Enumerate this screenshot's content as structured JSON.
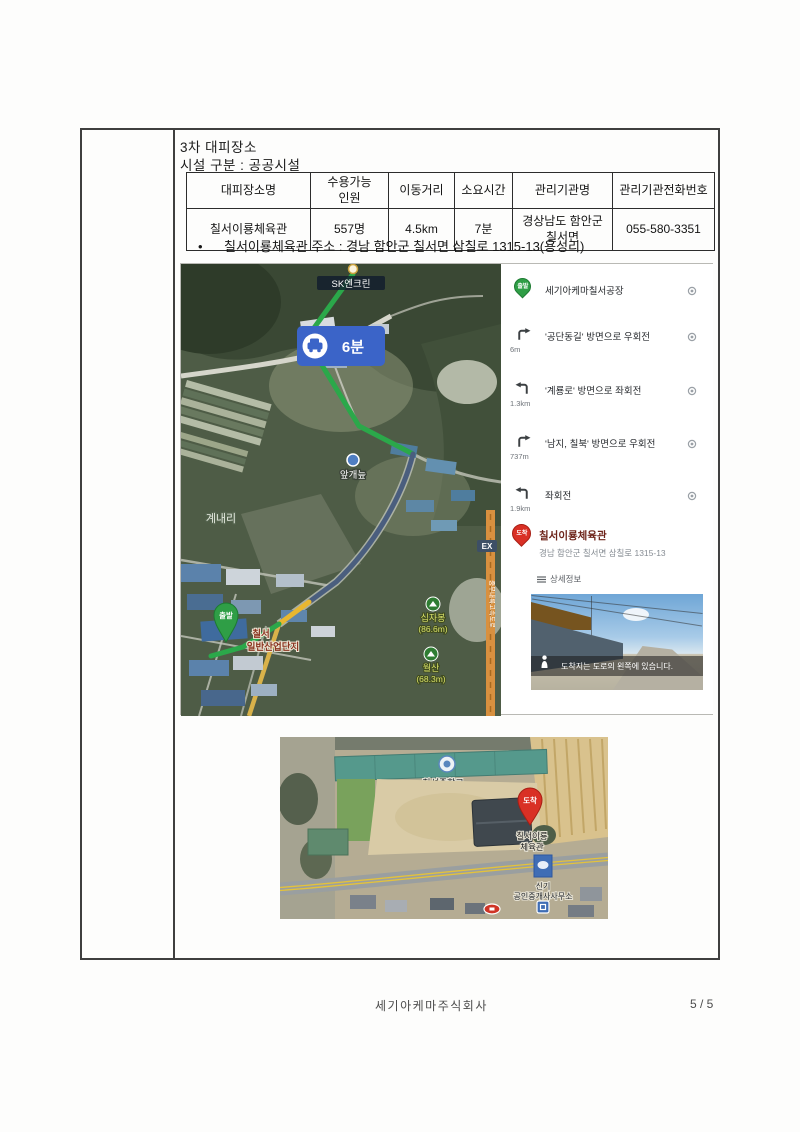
{
  "document": {
    "title": "3차 대피장소",
    "subtitle": "시설 구분 : 공공시설",
    "bullet": "칠서이룡체육관 주소 : 경남 함안군 칠서면 삼칠로 1315-13(용성리)",
    "footer_company": "세기아케마주식회사",
    "footer_page": "5 / 5"
  },
  "table": {
    "headers": {
      "name": "대피장소명",
      "capacity_l1": "수용가능",
      "capacity_l2": "인원",
      "distance": "이동거리",
      "time": "소요시간",
      "agency": "관리기관명",
      "phone": "관리기관전화번호"
    },
    "row": {
      "name": "칠서이룡체육관",
      "capacity": "557명",
      "distance": "4.5km",
      "time": "7분",
      "agency_l1": "경상남도 함안군",
      "agency_l2": "칠서면",
      "phone": "055-580-3351"
    }
  },
  "route_map": {
    "sk_station": "SK엔크린",
    "road_badge": "1021",
    "duration_badge": "6분",
    "wetland": "앞개늪",
    "village": "계내리",
    "ex_badge": "EX",
    "expressway": "중부내륙고속도로",
    "peak1_name": "십자봉",
    "peak1_elev": "(86.6m)",
    "peak2_name": "월산",
    "peak2_elev": "(68.3m)",
    "start_pin": "출발",
    "start_label_l1": "칠서",
    "start_label_l2": "일반산업단지",
    "colors": {
      "route_green": "#2ba84a",
      "route_blue": "#4a5e7e",
      "route_yellow": "#e8b730",
      "badge_blue": "#3b64c8"
    }
  },
  "directions": {
    "steps": [
      {
        "label": "세기아케마칠서공장",
        "distance": ""
      },
      {
        "label": "'공단동길' 방면으로 우회전",
        "distance": "6m"
      },
      {
        "label": "'계룡로' 방면으로 좌회전",
        "distance": "1.3km"
      },
      {
        "label": "'남지, 칠북' 방면으로 우회전",
        "distance": "737m"
      },
      {
        "label": "좌회전",
        "distance": "1.9km"
      }
    ],
    "dest_pin": "도착",
    "dest_name": "칠서이룡체육관",
    "dest_address": "경남 함안군 칠서면 삼칠로 1315-13",
    "details_label": "상세정보",
    "streetview_caption": "도착지는 도로의 왼쪽에 있습니다."
  },
  "site_map": {
    "school": "칠성중학교",
    "arrive_pin": "도착",
    "gym_l1": "칠서이룡",
    "gym_l2": "체육관",
    "office_l1": "신기",
    "office_l2": "공인중개사사무소"
  }
}
